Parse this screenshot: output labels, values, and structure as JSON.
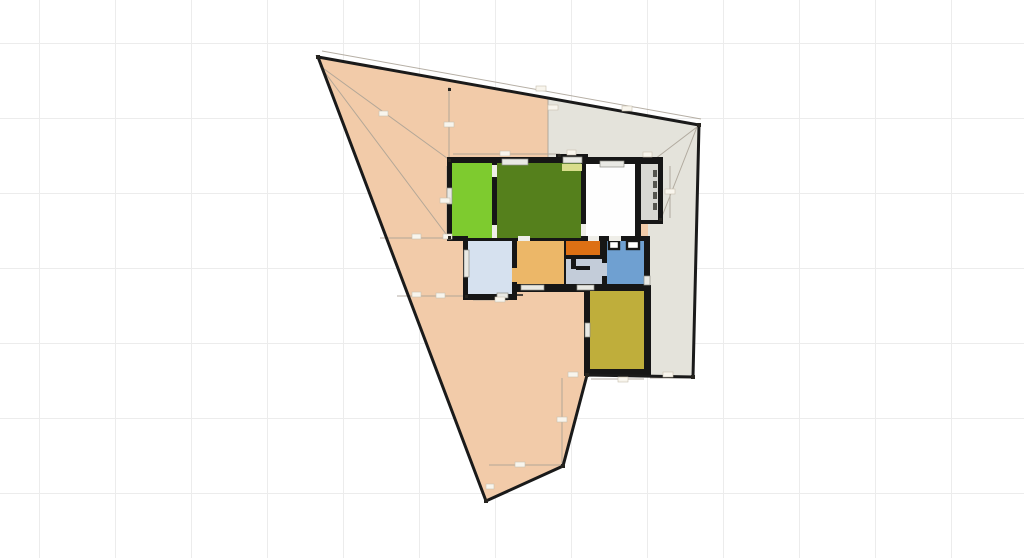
{
  "canvas": {
    "background": "#ffffff",
    "grid_line_color": "#ececec",
    "grid_size_px": 76
  },
  "surfaces": {
    "lot": {
      "fill": "#F2CBA9",
      "outline": "#1A1A1A"
    },
    "paved": {
      "fill": "#E4E3DB"
    }
  },
  "building": {
    "wall_color": "#161616",
    "window_color": "#E9E9E4",
    "door_gap_color": "#EFEEE8",
    "stair_hatch_color": "#55554F"
  },
  "rooms": {
    "green_light": {
      "fill": "#7ECB2F"
    },
    "green_dark": {
      "fill": "#55801C"
    },
    "white_room": {
      "fill": "#FEFEFE"
    },
    "stairs": {
      "fill": "#D8D8D3"
    },
    "light_blue": {
      "fill": "#D6E1EF"
    },
    "tan": {
      "fill": "#ECB768"
    },
    "orange": {
      "fill": "#DD7014"
    },
    "hall": {
      "fill": "#C3CCD9"
    },
    "blue": {
      "fill": "#6FA0D1"
    },
    "yellow": {
      "fill": "#BFAE3B"
    },
    "closet": {
      "fill": "#FFFFFF"
    },
    "sliver": {
      "fill": "#D9DE8C"
    }
  },
  "annotations": {
    "guide_color": "#A9A195",
    "chip_fill": "#F8F5ED",
    "handle_color": "#26241F"
  }
}
